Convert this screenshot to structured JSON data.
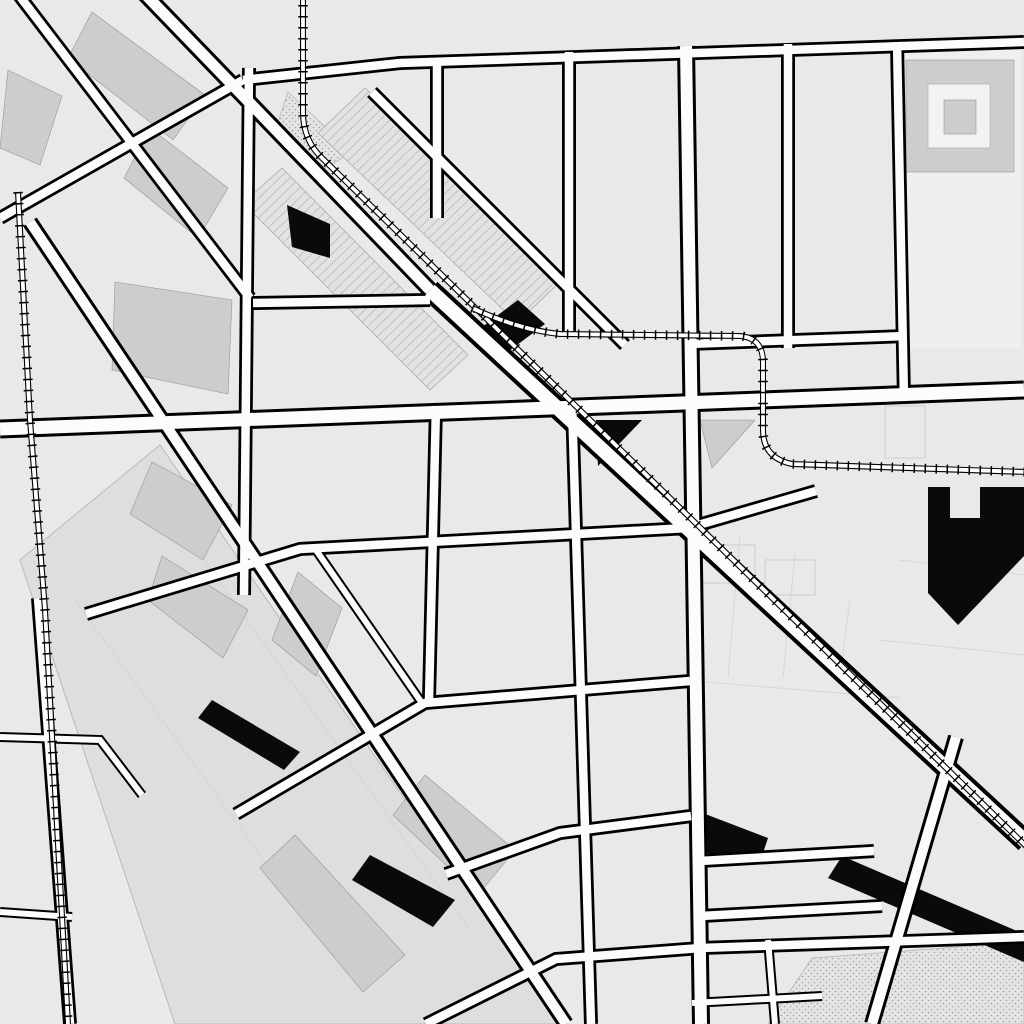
{
  "map": {
    "kind": "street-map",
    "style": "grayscale",
    "visible_neighborhood_features": [
      "street grid",
      "diagonal avenue with railway",
      "railway curves",
      "dotted park area",
      "building footprints"
    ]
  },
  "colors": {
    "background": "#e9e9e9",
    "road_fill": "#fcfcfc",
    "road_casing": "#000000",
    "building": "#cdcdcd",
    "black_building": "#0a0a0a",
    "label_text": "#757575",
    "river_band": "#dedede"
  },
  "streets": {
    "willow": "Willow St",
    "marcey": "Marcey St",
    "clybourn": "Clybourn Ave",
    "clybourn_line1": "Clybourn",
    "clybourn_line2": "Ave",
    "bissell": "Bissell St",
    "fremont": "Fremont St",
    "dayton": "Dayton St",
    "halsted": "Halsted St",
    "burling": "Burling St",
    "orchard": "Orchard St",
    "sheffield": "Sheffield Ave",
    "concord": "Concord Pl",
    "concord_line1": "Concord",
    "concord_line2": "Pl",
    "north": "North Ave",
    "kingsbury": "Kingsbury St",
    "weed": "Weed St",
    "blackhawk": "Blackhawk St",
    "eastman": "Eastman St",
    "cherry": "Cherry Ave",
    "ogden": "Ogden Ave",
    "evergreen": "Evergreen Ave",
    "evergreen_line1": "Evergreen",
    "evergreen_line2": "Ave",
    "fair": "Fair Pl"
  },
  "places": {
    "stanton": "Stanton",
    "clybourn_station": "Clybourn"
  }
}
